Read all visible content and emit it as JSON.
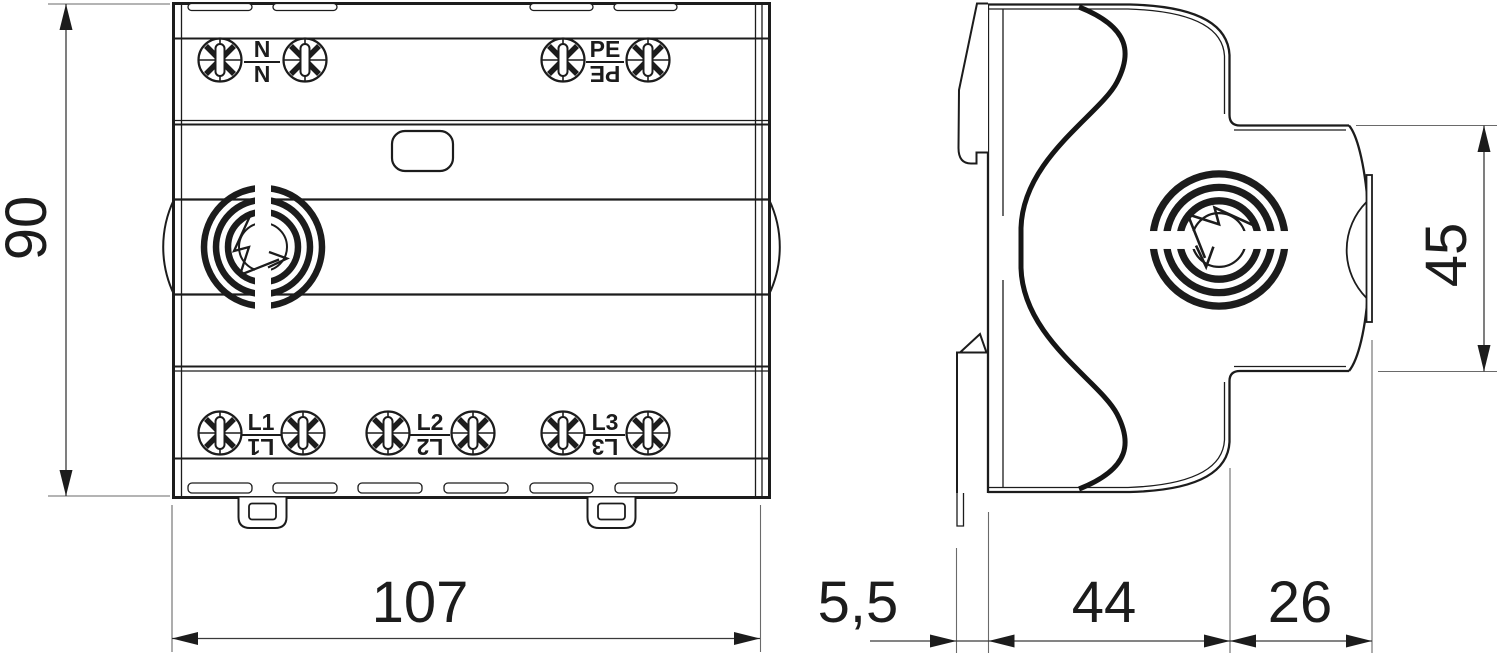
{
  "drawing": {
    "views": {
      "front": {
        "name": "front-view"
      },
      "side": {
        "name": "side-view"
      }
    },
    "terminal_labels": {
      "neutral": {
        "label": "N",
        "mirrored_label": "N"
      },
      "protective_earth": {
        "label": "PE",
        "mirrored_label": "PE"
      },
      "line1": {
        "label": "L1",
        "mirrored_label": "L1"
      },
      "line2": {
        "label": "L2",
        "mirrored_label": "L2"
      },
      "line3": {
        "label": "L3",
        "mirrored_label": "L3"
      }
    },
    "dimensions_mm": {
      "front_height": "90",
      "front_width": "107",
      "rail_offset_depth": "5,5",
      "body_depth": "44",
      "terminal_depth": "26",
      "front_section_height": "45"
    },
    "icons": {
      "logo": "surge-arrester-lightning-logo",
      "screw": "pozidriv-terminal-screw-icon"
    },
    "colors": {
      "line": "#1c1c1c",
      "background": "#ffffff"
    }
  }
}
